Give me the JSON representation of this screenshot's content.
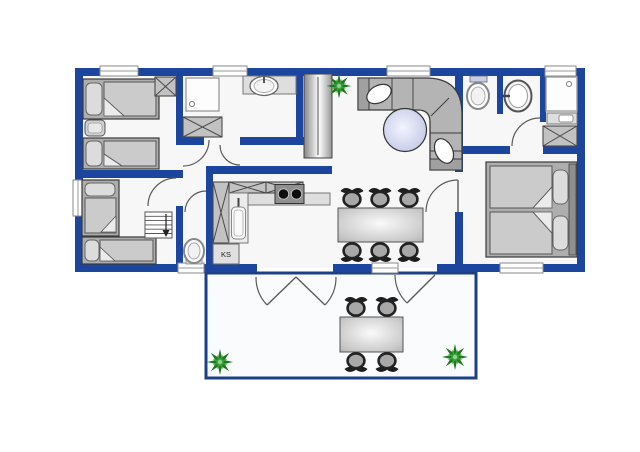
{
  "plan": {
    "type": "floor-plan",
    "labels": {
      "fridge": "KS"
    },
    "colors": {
      "wall": "#1c469e",
      "terrace_border": "#1c3f87",
      "floor": "#f6f7f6",
      "terrace_floor": "#fafbfd",
      "furniture_gray": "#b4b4b4",
      "plant_green": "#1d7a1d",
      "round_table": "#c5cbe8",
      "background": "#ffffff"
    }
  }
}
